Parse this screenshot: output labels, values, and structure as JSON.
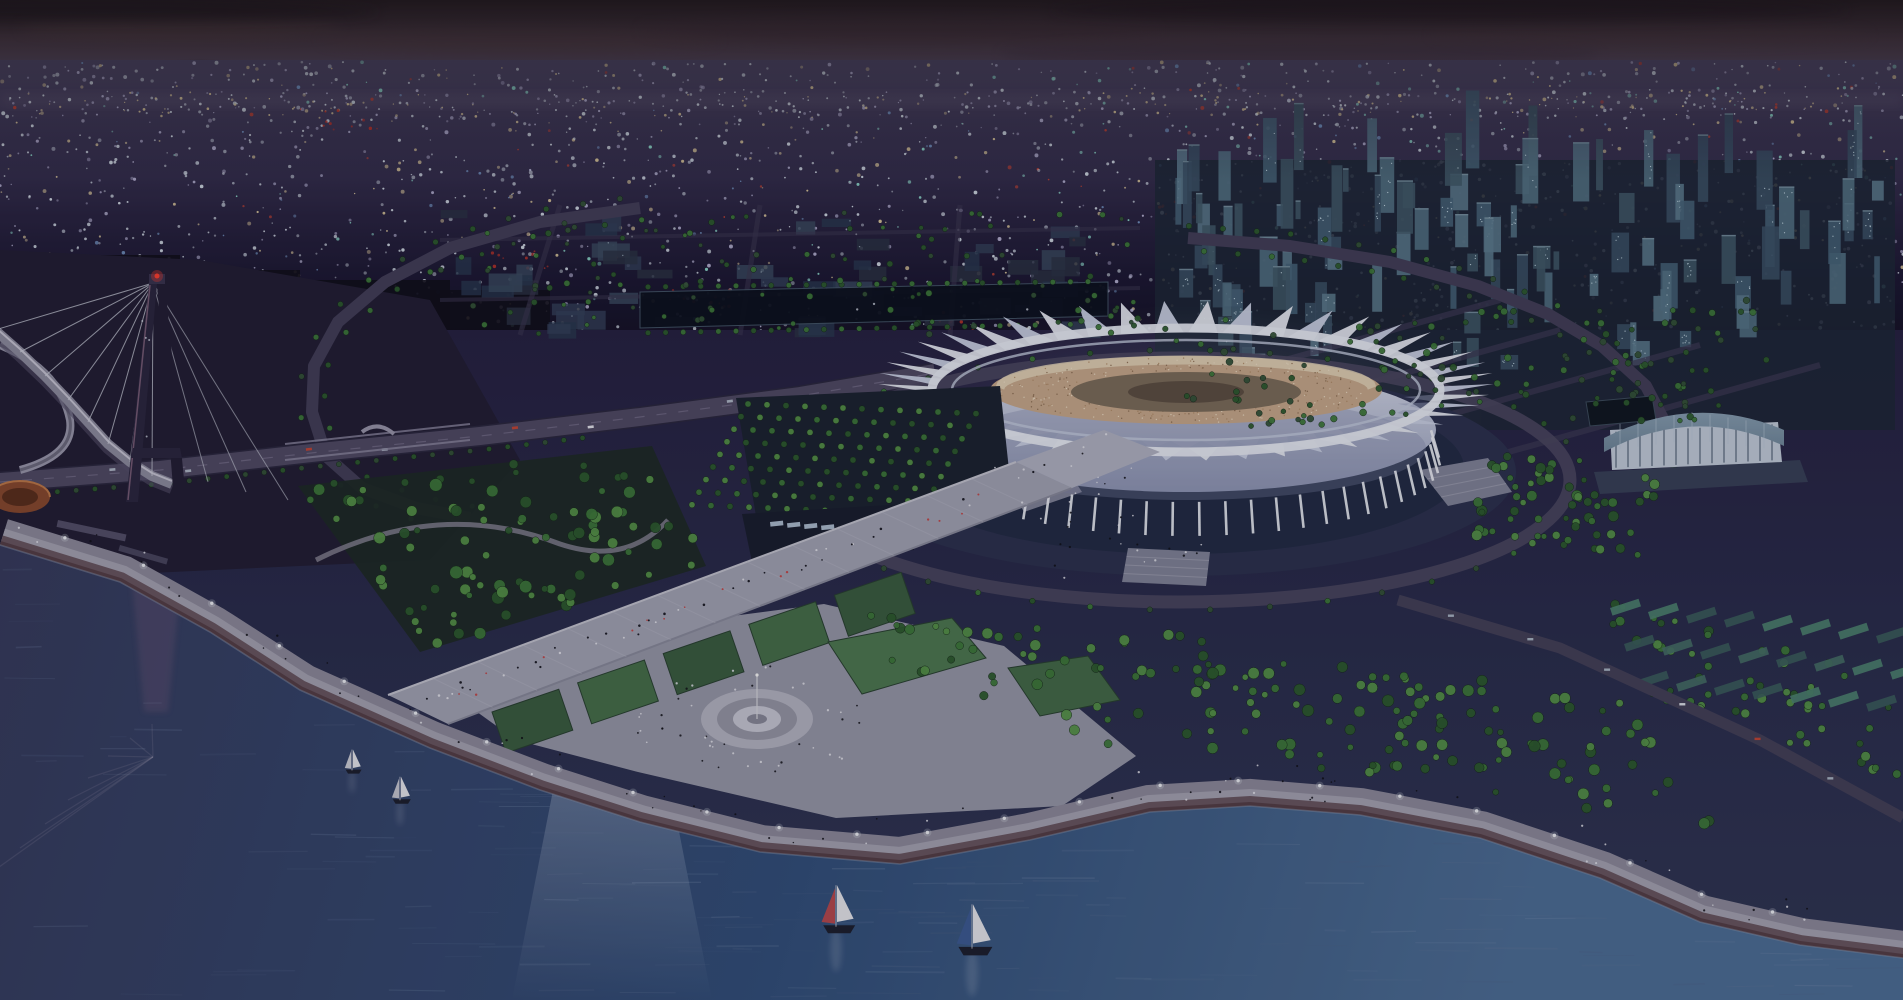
{
  "image": {
    "width": 1903,
    "height": 1000,
    "kind": "aerial-architectural-rendering",
    "time_of_day": "dusk"
  },
  "palette": {
    "sky_top": "#3b2f31",
    "sky_mid": "#5c4a55",
    "sky_haze": "#665a78",
    "horizon_glow": "#8a7a96",
    "city_hi": "#5b5374",
    "city_lo": "#151226",
    "land_hi": "#272243",
    "land_lo": "#323756",
    "water_top": "#383c5e",
    "water_mid": "#33507c",
    "water_low": "#46658e",
    "water_edge": "#8b9ab2",
    "stadium_white": "#e7eaf4",
    "stadium_white_alt": "#ccd3e6",
    "body_hi": "#d8dcec",
    "body_lo": "#9aa2c0",
    "seating": "#c9aa8d",
    "seating_light": "#e8d8bc",
    "seating_dark": "#8a6a50",
    "field": "#7e6e5c",
    "plaza": "#2d3250",
    "moat": "#232c46",
    "pool": "#7e9cbc",
    "pool_hi": "#a9c2d8",
    "walkway": "#a4a5b6",
    "walkway_edge_hi": "#c6c6d2",
    "walkway_edge_lo": "#8b8c9e",
    "promenade": "#a6a4b4",
    "promenade_wide": "#8e8b9d",
    "promenade_steps": "#6a5762",
    "promenade_low": "#563f48",
    "lawn_a": "#3c5e42",
    "lawn_b": "#47704b",
    "lawn_bright": "#4f7a52",
    "tree_a": "#3f7a3c",
    "tree_b": "#57944a",
    "tree_c": "#2e5c30",
    "tree_dim": "#35543a",
    "tree_rim": "#16281a",
    "road": "#514b66",
    "road_dark": "#2c2840",
    "ring_road": "#443f5a",
    "median": "#7a7490",
    "tower_a": "#3c5268",
    "tower_b": "#48647a",
    "tower_c": "#557488",
    "tower_d": "#425a6a",
    "window": "#cfe4ee",
    "block_a": "#2c3346",
    "block_b": "#34415a",
    "block_c": "#3c4c62",
    "bridge_dark": "#2c2740",
    "bridge_edge": "#8a6a84",
    "cable": "#cfd2de",
    "beacon": "#ff4030",
    "deck": "#8f8da0",
    "deck_hi": "#c9c7d6",
    "deck_lo": "#55506a",
    "rotunda": "#8a4a30",
    "rotunda_in": "#5c2f1e",
    "rotunda_rim": "#c07a4a",
    "arena_roof_hi": "#96acc0",
    "arena_roof_lo": "#70889c",
    "arena_wall": "#c4cedc",
    "arena_plinth": "#39415a",
    "boat_sail": "#e8e9ee",
    "hull": "#1e2030",
    "lamp": "#eef0f6",
    "people_dark": "#101018",
    "people_light": "#e8e8f0",
    "canal_water": "#0d1220",
    "overlay": "#05050d"
  },
  "lights": {
    "seed": 1337,
    "count": 2200,
    "horizon_count": 320,
    "region": {
      "x": 0,
      "y": 62,
      "w": 1903,
      "h": 285
    },
    "colors": [
      "#d9e2ec",
      "#b9b5d6",
      "#e3cfa0",
      "#93e2d2",
      "#7fa6d6",
      "#cf4634"
    ],
    "red_clusters": [
      [
        350,
        120
      ],
      [
        520,
        260
      ],
      [
        700,
        300
      ],
      [
        880,
        300
      ],
      [
        960,
        322
      ],
      [
        1180,
        210
      ]
    ]
  },
  "coast": [
    [
      0,
      545
    ],
    [
      120,
      582
    ],
    [
      210,
      632
    ],
    [
      300,
      690
    ],
    [
      430,
      748
    ],
    [
      540,
      790
    ],
    [
      640,
      822
    ],
    [
      760,
      852
    ],
    [
      900,
      864
    ],
    [
      1030,
      840
    ],
    [
      1150,
      812
    ],
    [
      1250,
      806
    ],
    [
      1360,
      815
    ],
    [
      1480,
      838
    ],
    [
      1600,
      878
    ],
    [
      1700,
      922
    ],
    [
      1800,
      945
    ],
    [
      1903,
      958
    ]
  ],
  "stadium": {
    "cx": 1186,
    "cy": 390,
    "rx": 250,
    "ry": 58,
    "spikes": 46,
    "ribs": 31,
    "body": {
      "cx": 1186,
      "cy": 430,
      "rx": 250,
      "ry": 62
    },
    "bowl": {
      "cx": 1186,
      "cy": 390,
      "rx": 196,
      "ry": 34
    },
    "field": {
      "cx": 1186,
      "cy": 392,
      "rx": 115,
      "ry": 20
    },
    "plaza": {
      "cx": 1180,
      "cy": 472,
      "rx": 336,
      "ry": 104
    },
    "moat": {
      "cx": 1180,
      "cy": 468,
      "rx": 284,
      "ry": 86
    },
    "pool": {
      "cx": 1180,
      "cy": 462,
      "rx": 260,
      "ry": 82
    },
    "ring_road": {
      "cx": 1180,
      "cy": 480,
      "rx": 390,
      "ry": 122
    }
  },
  "aprons": [
    [
      [
        1000,
        470
      ],
      [
        1056,
        452
      ],
      [
        1082,
        492
      ],
      [
        1024,
        512
      ]
    ],
    [
      [
        1128,
        548
      ],
      [
        1210,
        552
      ],
      [
        1206,
        586
      ],
      [
        1122,
        582
      ]
    ],
    [
      [
        1420,
        470
      ],
      [
        1488,
        458
      ],
      [
        1512,
        492
      ],
      [
        1448,
        506
      ]
    ]
  ],
  "bridge": {
    "apex": [
      153,
      283
    ],
    "beacon": [
      157,
      276
    ],
    "deck": [
      [
        -5,
        330
      ],
      [
        20,
        352
      ],
      [
        45,
        376
      ],
      [
        68,
        400
      ],
      [
        88,
        422
      ],
      [
        108,
        444
      ],
      [
        130,
        462
      ],
      [
        152,
        476
      ],
      [
        172,
        484
      ]
    ],
    "left_leg": [
      [
        149,
        283
      ],
      [
        157,
        283
      ],
      [
        138,
        502
      ],
      [
        126,
        502
      ]
    ],
    "right_leg": [
      [
        157,
        283
      ],
      [
        165,
        283
      ],
      [
        186,
        500
      ],
      [
        174,
        500
      ]
    ],
    "crossbeam": [
      [
        133,
        448
      ],
      [
        180,
        448
      ],
      [
        182,
        458
      ],
      [
        131,
        458
      ]
    ],
    "backstays": [
      [
        208,
        482
      ],
      [
        246,
        492
      ],
      [
        288,
        500
      ]
    ],
    "reflect_apex": [
      153,
      757
    ],
    "water_line": 520
  },
  "rotunda": {
    "cx": 20,
    "cy": 497,
    "rx": 30,
    "ry": 16
  },
  "boats": [
    {
      "x": 352,
      "y": 772,
      "s": 0.8,
      "jib": "#cfd0da"
    },
    {
      "x": 400,
      "y": 802,
      "s": 0.9,
      "jib": "#c8c9d4"
    },
    {
      "x": 836,
      "y": 930,
      "s": 1.6,
      "jib": "#b84a50"
    },
    {
      "x": 972,
      "y": 952,
      "s": 1.7,
      "jib": "#3e5c96"
    }
  ],
  "fountain": {
    "cx": 757,
    "cy": 719,
    "rings": [
      [
        56,
        30,
        "#b6b6c4"
      ],
      [
        40,
        21,
        "#9898a8"
      ],
      [
        24,
        13,
        "#c9c9d6"
      ],
      [
        10,
        5,
        "#8a8a9a"
      ]
    ]
  },
  "arena": {
    "plinth": [
      [
        1594,
        472
      ],
      [
        1800,
        460
      ],
      [
        1808,
        482
      ],
      [
        1600,
        494
      ]
    ],
    "wall": [
      [
        1610,
        430
      ],
      [
        1778,
        422
      ],
      [
        1782,
        462
      ],
      [
        1612,
        470
      ]
    ],
    "pool": [
      [
        1586,
        402
      ],
      [
        1652,
        396
      ],
      [
        1656,
        420
      ],
      [
        1590,
        426
      ]
    ]
  },
  "canal": [
    [
      640,
      292
    ],
    [
      1108,
      282
    ],
    [
      1108,
      316
    ],
    [
      640,
      328
    ]
  ],
  "parking": {
    "lot": [
      [
        742,
        514
      ],
      [
        906,
        504
      ],
      [
        914,
        550
      ],
      [
        752,
        562
      ]
    ],
    "buses": 6
  },
  "walkway": {
    "main": [
      [
        388,
        695
      ],
      [
        448,
        724
      ],
      [
        1072,
        488
      ],
      [
        1016,
        462
      ]
    ],
    "bridge": [
      [
        1016,
        462
      ],
      [
        1072,
        488
      ],
      [
        1160,
        452
      ],
      [
        1104,
        430
      ]
    ]
  },
  "highway": [
    [
      0,
      482
    ],
    [
      160,
      470
    ],
    [
      320,
      452
    ],
    [
      480,
      436
    ],
    [
      640,
      417
    ],
    [
      800,
      396
    ],
    [
      935,
      373
    ]
  ],
  "rings": {
    "left": [
      [
        640,
        208
      ],
      [
        540,
        222
      ],
      [
        450,
        248
      ],
      [
        385,
        282
      ],
      [
        338,
        322
      ],
      [
        314,
        366
      ],
      [
        312,
        412
      ],
      [
        326,
        456
      ],
      [
        362,
        488
      ],
      [
        416,
        508
      ],
      [
        470,
        518
      ]
    ],
    "right": [
      [
        1188,
        238
      ],
      [
        1290,
        246
      ],
      [
        1390,
        262
      ],
      [
        1478,
        286
      ],
      [
        1548,
        314
      ],
      [
        1602,
        346
      ],
      [
        1646,
        386
      ],
      [
        1668,
        428
      ],
      [
        1662,
        466
      ]
    ]
  },
  "se_road": [
    [
      1398,
      600
    ],
    [
      1560,
      648
    ],
    [
      1760,
      740
    ],
    [
      1903,
      818
    ]
  ],
  "lawns": {
    "count": 5,
    "start": [
      492,
      712
    ],
    "end": [
      920,
      566
    ]
  },
  "lawn_patches": [
    [
      [
        828,
        642
      ],
      [
        952,
        618
      ],
      [
        986,
        658
      ],
      [
        862,
        694
      ]
    ],
    [
      [
        1008,
        668
      ],
      [
        1088,
        656
      ],
      [
        1120,
        700
      ],
      [
        1040,
        716
      ]
    ]
  ],
  "plaza_poly": [
    [
      466,
      704
    ],
    [
      640,
      628
    ],
    [
      824,
      604
    ],
    [
      1004,
      646
    ],
    [
      1136,
      756
    ],
    [
      1062,
      806
    ],
    [
      836,
      818
    ],
    [
      638,
      772
    ],
    [
      516,
      740
    ]
  ],
  "shore_band": [
    [
      0,
      545
    ],
    [
      120,
      582
    ],
    [
      210,
      632
    ],
    [
      300,
      690
    ],
    [
      430,
      748
    ],
    [
      452,
      734
    ],
    [
      322,
      672
    ],
    [
      232,
      614
    ],
    [
      138,
      562
    ],
    [
      10,
      528
    ]
  ],
  "towers": {
    "x": 1155,
    "y": 160,
    "w": 740,
    "h": 210,
    "count": 115
  },
  "town": {
    "x": 440,
    "y": 205,
    "w": 690,
    "h": 125,
    "count": 55
  },
  "silhouettes": [
    [
      0,
      255,
      180,
      90
    ],
    [
      160,
      270,
      140,
      75
    ],
    [
      290,
      280,
      160,
      65
    ],
    [
      430,
      290,
      120,
      55
    ]
  ],
  "houses_se": {
    "rows": 3,
    "cols": 8,
    "origin": [
      1610,
      608
    ]
  },
  "tree_grid_west": {
    "origin": [
      748,
      404
    ],
    "rows": 9,
    "cols": 13,
    "col_step": [
      19,
      0.8
    ],
    "row_step": [
      -7,
      12.6
    ],
    "r": 3.1
  },
  "tree_clusters": [
    {
      "name": "park-northwest",
      "poly": [
        [
          298,
          486
        ],
        [
          652,
          446
        ],
        [
          706,
          566
        ],
        [
          420,
          652
        ]
      ],
      "count": 95,
      "rmin": 3,
      "rmax": 6.5
    },
    {
      "name": "fountain-east",
      "poly": [
        [
          860,
          600
        ],
        [
          1140,
          640
        ],
        [
          1150,
          760
        ],
        [
          900,
          690
        ]
      ],
      "count": 40,
      "rmin": 3,
      "rmax": 5.5
    },
    {
      "name": "shore-southeast",
      "poly": [
        [
          1140,
          630
        ],
        [
          1620,
          700
        ],
        [
          1720,
          830
        ],
        [
          1500,
          800
        ],
        [
          1160,
          740
        ]
      ],
      "count": 120,
      "rmin": 3,
      "rmax": 6
    },
    {
      "name": "houses-southeast",
      "poly": [
        [
          1600,
          600
        ],
        [
          1903,
          680
        ],
        [
          1903,
          780
        ],
        [
          1650,
          700
        ]
      ],
      "count": 55,
      "rmin": 3,
      "rmax": 5
    },
    {
      "name": "arena-park",
      "poly": [
        [
          1488,
          450
        ],
        [
          1660,
          470
        ],
        [
          1640,
          560
        ],
        [
          1470,
          540
        ]
      ],
      "count": 60,
      "rmin": 3,
      "rmax": 5.5
    },
    {
      "name": "towers-greenbelt",
      "poly": [
        [
          1150,
          320
        ],
        [
          1750,
          300
        ],
        [
          1800,
          420
        ],
        [
          1180,
          430
        ]
      ],
      "count": 130,
      "rmin": 2.4,
      "rmax": 3.6
    },
    {
      "name": "midtown-trees",
      "poly": [
        [
          440,
          212
        ],
        [
          1140,
          212
        ],
        [
          1140,
          336
        ],
        [
          440,
          336
        ]
      ],
      "count": 110,
      "rmin": 2,
      "rmax": 3.2
    }
  ],
  "crowd_plaza_poly": [
    [
      990,
      460
    ],
    [
      1120,
      430
    ],
    [
      1240,
      560
    ],
    [
      1060,
      580
    ]
  ],
  "beam": [
    [
      556,
      775
    ],
    [
      668,
      775
    ],
    [
      712,
      1000
    ],
    [
      512,
      1000
    ]
  ],
  "counts": {
    "waves": 150,
    "lamps": 24,
    "cars": 8,
    "walkway_people": 55,
    "fountain_people": 45,
    "promenade_people": 70,
    "plaza_people": 40
  },
  "overlay_opacity": 0.17
}
